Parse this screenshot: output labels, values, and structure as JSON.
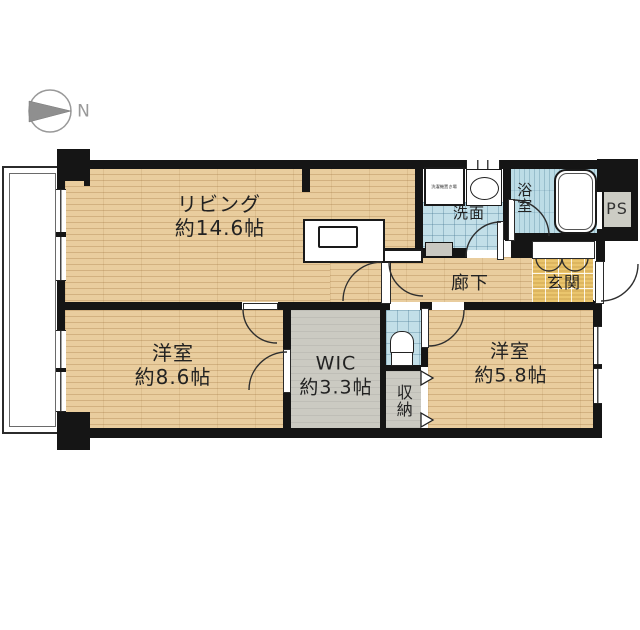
{
  "compass": {
    "label": "N"
  },
  "rooms": {
    "living": {
      "name": "リビング",
      "size": "約14.6帖"
    },
    "bedroom_left": {
      "name": "洋室",
      "size": "約8.6帖"
    },
    "wic": {
      "name": "WIC",
      "size": "約3.3帖"
    },
    "storage": {
      "name": "収納"
    },
    "bedroom_right": {
      "name": "洋室",
      "size": "約5.8帖"
    },
    "hallway": {
      "name": "廊下"
    },
    "washroom": {
      "name": "洗面"
    },
    "bathroom": {
      "name": "浴室"
    },
    "entrance": {
      "name": "玄関"
    },
    "pipe_space": {
      "name": "PS"
    }
  },
  "fixtures": {
    "washer_area": "洗濯機置き場"
  },
  "colors": {
    "wall": "#151515",
    "wood_floor": "#e9cd9e",
    "wet_tile": "#c2dfe8",
    "closet_floor": "#cbcac2",
    "entrance_tile": "#eac56d",
    "compass_gray": "#8f8f8f"
  }
}
